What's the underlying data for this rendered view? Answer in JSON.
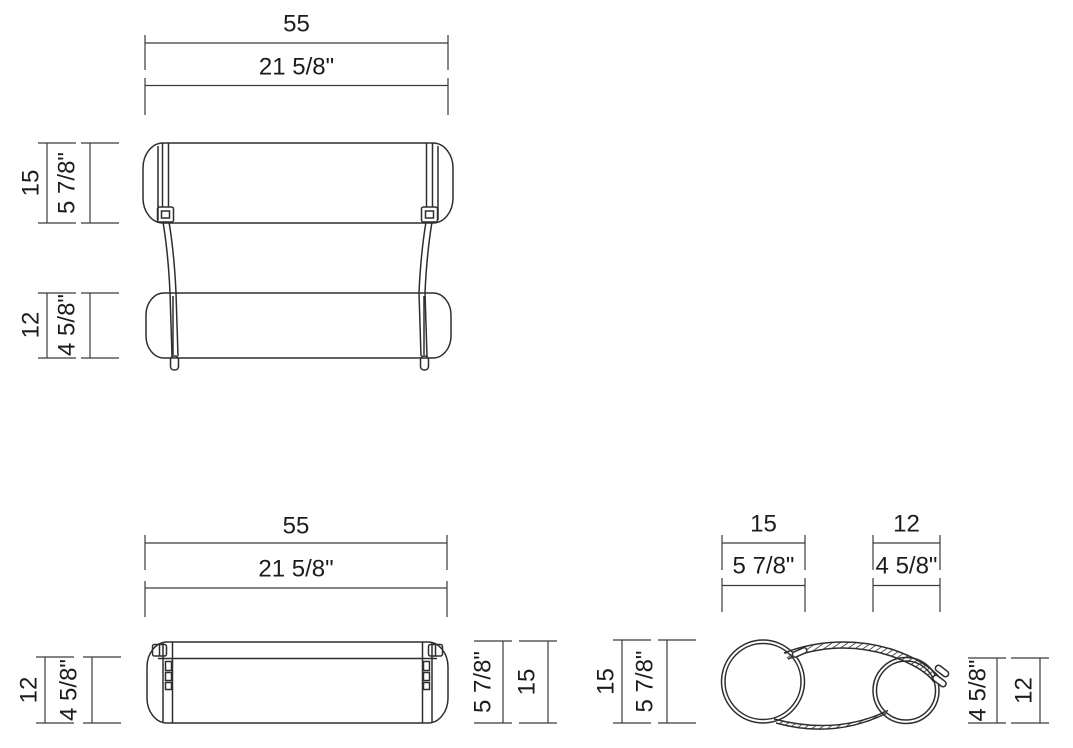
{
  "dims": {
    "front": {
      "width_cm": "55",
      "width_in": "21 5/8\"",
      "upper_cm": "15",
      "upper_in": "5 7/8\"",
      "lower_cm": "12",
      "lower_in": "4 5/8\""
    },
    "single": {
      "width_cm": "55",
      "width_in": "21 5/8\"",
      "front_cm": "12",
      "front_in": "4 5/8\"",
      "full_cm": "15",
      "full_in": "5 7/8\""
    },
    "side": {
      "large_top_cm": "15",
      "large_top_in": "5 7/8\"",
      "small_top_cm": "12",
      "small_top_in": "4 5/8\"",
      "left_cm": "15",
      "left_in": "5 7/8\"",
      "right_cm": "12",
      "right_in": "4 5/8\""
    }
  }
}
